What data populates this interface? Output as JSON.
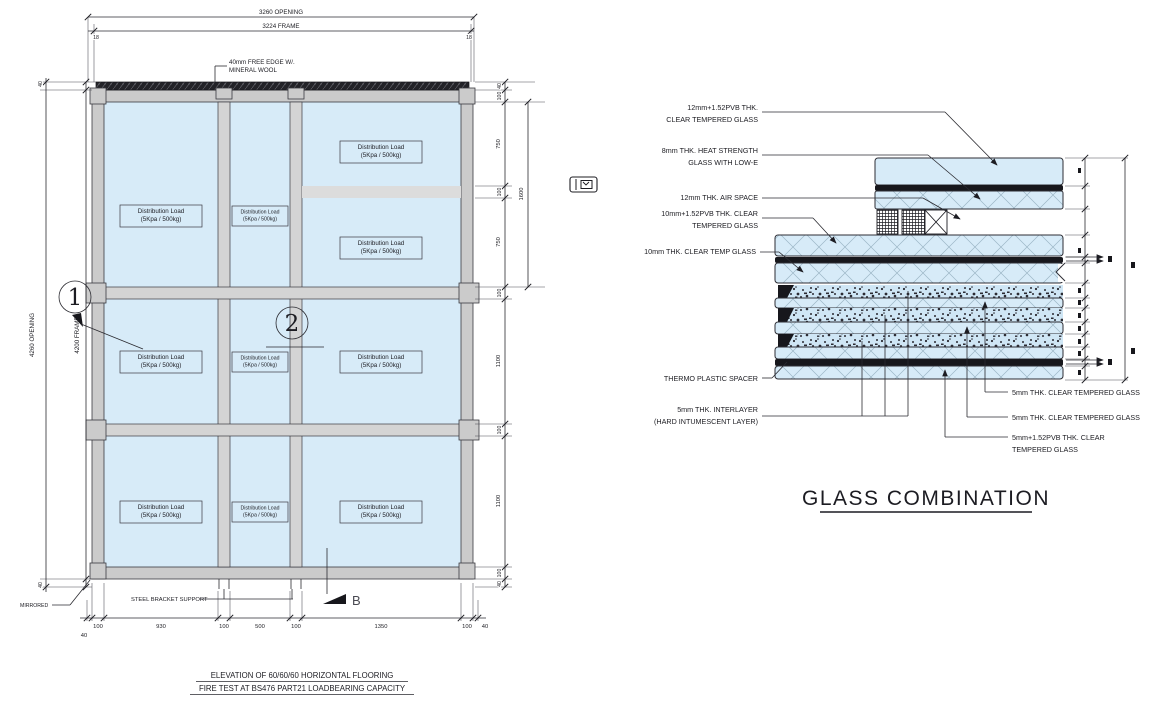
{
  "colors": {
    "glass": "#d7ebf8",
    "frame_gray": "#cbcbcb",
    "line_dark": "#2a2a30",
    "pvb_dark": "#17171c"
  },
  "elevation": {
    "title1": "ELEVATION OF 60/60/60 HORIZONTAL FLOORING",
    "title2": "FIRE TEST AT BS476 PART21 LOADBEARING CAPACITY",
    "dims_top": {
      "opening": "3260 OPENING",
      "frame": "3224 FRAME",
      "side_left": "18",
      "side_right": "18"
    },
    "dims_left": {
      "opening": "4260 OPENING",
      "frame": "4200 FRAME",
      "top": "40",
      "bottom": "40"
    },
    "dims_right": [
      "40",
      "100",
      "750",
      "100",
      "750",
      "1600",
      "100",
      "1100",
      "100",
      "1100",
      "100",
      "40"
    ],
    "dims_bottom": [
      "40",
      "100",
      "930",
      "100",
      "500",
      "100",
      "1350",
      "100",
      "40"
    ],
    "load_line1": "Distribution Load",
    "load_line2": "(5Kpa / 500kg)",
    "note_free_edge1": "40mm FREE EDGE W/.",
    "note_free_edge2": "MINERAL WOOL",
    "note_mirrored": "MIRRORED",
    "note_steel_bracket": "STEEL BRACKET SUPPORT",
    "marker_1": "1",
    "marker_2": "2",
    "marker_b": "B"
  },
  "glass_combination": {
    "title": "GLASS COMBINATION",
    "left_labels": [
      [
        "12mm+1.52PVB THK.",
        "CLEAR TEMPERED GLASS"
      ],
      [
        "8mm THK. HEAT STRENGTH",
        "GLASS WITH LOW-E"
      ],
      [
        "12mm THK. AIR SPACE"
      ],
      [
        "10mm+1.52PVB THK. CLEAR",
        "TEMPERED GLASS"
      ],
      [
        "10mm THK. CLEAR TEMP GLASS"
      ],
      [
        "THERMO PLASTIC SPACER"
      ],
      [
        "5mm THK. INTERLAYER",
        "(HARD INTUMESCENT LAYER)"
      ]
    ],
    "right_labels": [
      [
        "5mm THK. CLEAR TEMPERED GLASS"
      ],
      [
        "5mm THK. CLEAR TEMPERED GLASS"
      ],
      [
        "5mm+1.52PVB THK. CLEAR",
        "TEMPERED GLASS"
      ]
    ]
  }
}
